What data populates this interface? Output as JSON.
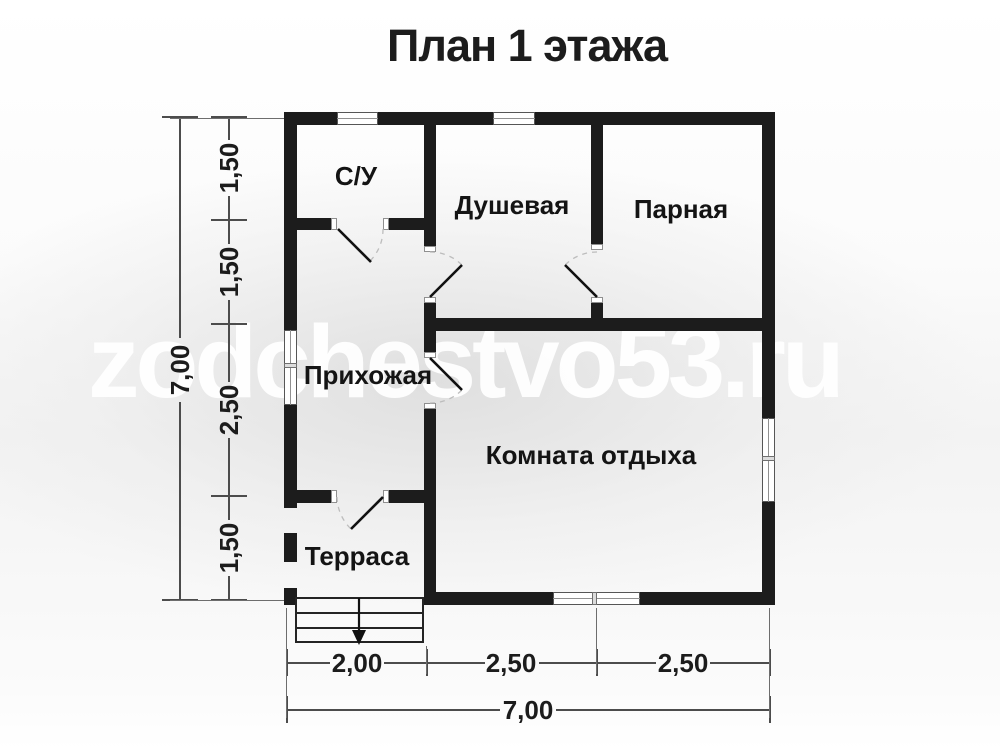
{
  "title": "План 1 этажа",
  "watermark": "zodchestvo53.ru",
  "rooms": [
    {
      "id": "su",
      "label": "С/У"
    },
    {
      "id": "dushevaya",
      "label": "Душевая"
    },
    {
      "id": "parnaya",
      "label": "Парная"
    },
    {
      "id": "prihozhaya",
      "label": "Прихожая"
    },
    {
      "id": "komnata-otdyha",
      "label": "Комната отдыха"
    },
    {
      "id": "terrasa",
      "label": "Терраса"
    }
  ],
  "dimensions": {
    "left": {
      "segments": [
        "1,50",
        "1,50",
        "2,50",
        "1,50"
      ],
      "total": "7,00"
    },
    "bottom": {
      "segments": [
        "2,00",
        "2,50",
        "2,50"
      ],
      "total": "7,00"
    }
  },
  "icons": {
    "stairs_arrow": "entry-steps-down-arrow",
    "door_swing": "door-swing-arc",
    "window": "window-symbol"
  }
}
